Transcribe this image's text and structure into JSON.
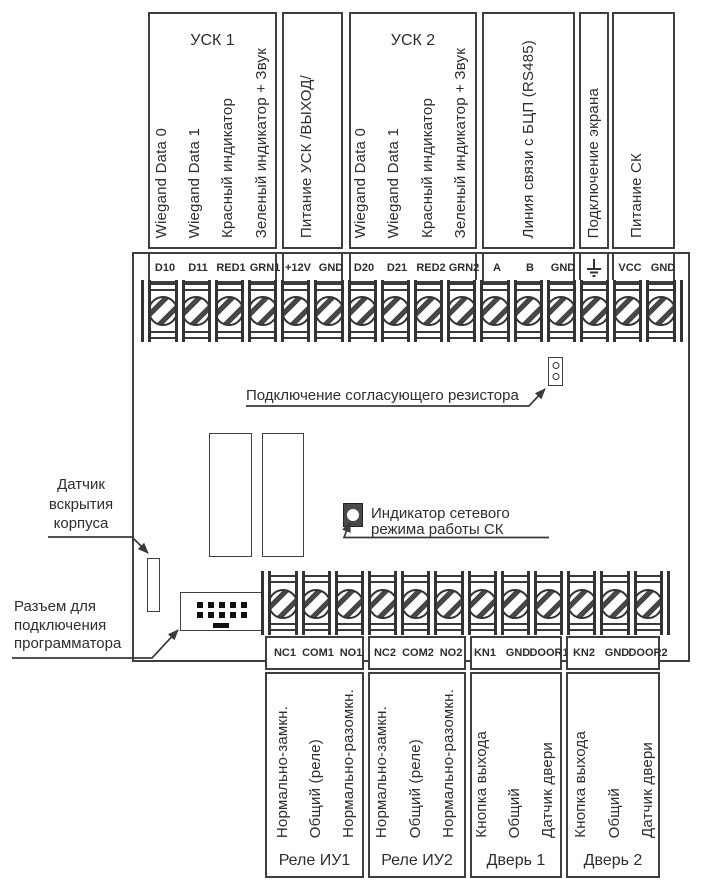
{
  "diagram": {
    "top_groups": [
      {
        "title": "УСК 1",
        "signals": [
          "Wiegand Data 0",
          "Wiegand Data 1",
          "Красный индикатор",
          "Зеленый  индикатор + Звук"
        ],
        "terminals": [
          "D10",
          "D11",
          "RED1",
          "GRN1"
        ]
      },
      {
        "title": "",
        "signals": [
          "Питание УСК  /ВЫХОД/"
        ],
        "terminals": [
          "+12V",
          "GND"
        ]
      },
      {
        "title": "УСК 2",
        "signals": [
          "Wiegand Data 0",
          "Wiegand Data 1",
          "Красный индикатор",
          "Зеленый  индикатор + Звук"
        ],
        "terminals": [
          "D20",
          "D21",
          "RED2",
          "GRN2"
        ]
      },
      {
        "title": "",
        "signals": [
          "Линия связи с БЦП (RS485)"
        ],
        "terminals": [
          "A",
          "B",
          "GND"
        ]
      },
      {
        "title": "",
        "signals": [
          "Подключение экрана"
        ],
        "terminals": [],
        "terminal_icon": "earth-ground-icon"
      },
      {
        "title": "",
        "signals": [
          "Питание СК"
        ],
        "terminals": [
          "VCC",
          "GND"
        ]
      }
    ],
    "bottom_groups": [
      {
        "title": "Реле ИУ1",
        "signals": [
          "Нормально-замкн.",
          "Общий (реле)",
          "Нормально-разомкн."
        ],
        "terminals": [
          "NC1",
          "COM1",
          "NO1"
        ]
      },
      {
        "title": "Реле ИУ2",
        "signals": [
          "Нормально-замкн.",
          "Общий (реле)",
          "Нормально-разомкн."
        ],
        "terminals": [
          "NC2",
          "COM2",
          "NO2"
        ]
      },
      {
        "title": "Дверь 1",
        "signals": [
          "Кнопка выхода",
          "Общий",
          "Датчик двери"
        ],
        "terminals": [
          "KN1",
          "GND",
          "DOOR1"
        ]
      },
      {
        "title": "Дверь 2",
        "signals": [
          "Кнопка выхода",
          "Общий",
          "Датчик двери"
        ],
        "terminals": [
          "KN2",
          "GND",
          "DOOR2"
        ]
      }
    ],
    "annotations": {
      "resistor_label": "Подключение согласующего резистора",
      "tamper_lines": [
        "Датчик",
        "вскрытия",
        "корпуса"
      ],
      "programmer_lines": [
        "Разъем для",
        "подключения",
        "программатора"
      ],
      "led_lines": [
        "Индикатор сетевого",
        "режима работы СК"
      ]
    },
    "colors": {
      "line": "#3a3a3a",
      "led_body": "#4a4a4a",
      "pin": "#111111"
    }
  }
}
